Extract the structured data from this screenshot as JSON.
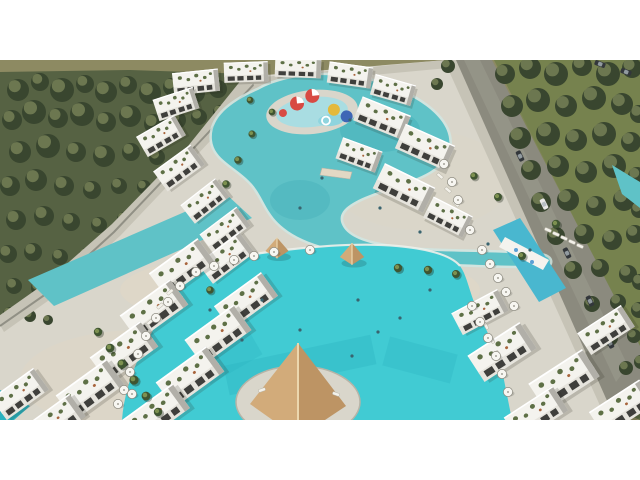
{
  "scene": {
    "name": "aerial-3d-render-resort-compound-with-lagoon-pools",
    "palette": {
      "sky": "#8d8a62",
      "forest_base": "#566243",
      "tree_dark": "#39462f",
      "tree_light": "#97a06c",
      "lawn": "#76824e",
      "lawn_dark": "#5a6942",
      "road": "#8b8a7e",
      "road_light": "#a09f92",
      "wall_light": "#c6c3b6",
      "wall_shadow": "#7b7a70",
      "deck": "#d9d6cb",
      "deck_warm": "#e2d8c4",
      "deck_shadow": "#b7b4a7",
      "lagoon": "#5fc2c7",
      "lagoon_deep": "#3da9b4",
      "splash": "#a9dde2",
      "pool": "#41cbd3",
      "pool_deep": "#2ab2c0",
      "building": "#f4f3ee",
      "building_face": "#e6e4dd",
      "building_shadow": "#b1afa8",
      "window": "#3f3f3c",
      "roof_green": "#5e7046",
      "terra": "#a8643c",
      "palm_dark": "#3f5531",
      "palm_light": "#7d9150",
      "umbrella": "#f7f6f1",
      "umbrella_rim": "#8b897e",
      "gazebo_top": "#ecd7ae",
      "gazebo_left": "#d2ab7a",
      "gazebo_right": "#bd9464",
      "slide_red": "#d84a43",
      "slide_yellow": "#e3b93c",
      "slide_blue": "#3e66b5",
      "car_dark": "#33373b",
      "car_white": "#e9e9e7",
      "swimmer": "#39646f",
      "letterbox": "#ffffff"
    },
    "trees_left": [
      [
        18,
        30,
        11
      ],
      [
        40,
        22,
        9
      ],
      [
        62,
        30,
        12
      ],
      [
        85,
        24,
        9
      ],
      [
        106,
        32,
        11
      ],
      [
        128,
        25,
        9
      ],
      [
        150,
        33,
        11
      ],
      [
        172,
        27,
        9
      ],
      [
        195,
        33,
        10
      ],
      [
        218,
        29,
        9
      ],
      [
        240,
        35,
        8
      ],
      [
        12,
        60,
        10
      ],
      [
        34,
        52,
        12
      ],
      [
        58,
        58,
        10
      ],
      [
        82,
        54,
        12
      ],
      [
        106,
        62,
        10
      ],
      [
        130,
        56,
        11
      ],
      [
        154,
        64,
        10
      ],
      [
        177,
        60,
        9
      ],
      [
        199,
        57,
        8
      ],
      [
        220,
        52,
        7
      ],
      [
        20,
        92,
        11
      ],
      [
        48,
        86,
        12
      ],
      [
        76,
        92,
        10
      ],
      [
        104,
        96,
        11
      ],
      [
        131,
        92,
        9
      ],
      [
        157,
        97,
        8
      ],
      [
        10,
        126,
        10
      ],
      [
        36,
        120,
        11
      ],
      [
        64,
        126,
        10
      ],
      [
        92,
        130,
        9
      ],
      [
        119,
        126,
        8
      ],
      [
        144,
        127,
        7
      ],
      [
        16,
        160,
        10
      ],
      [
        44,
        156,
        10
      ],
      [
        71,
        162,
        9
      ],
      [
        99,
        165,
        8
      ],
      [
        124,
        159,
        7
      ],
      [
        8,
        194,
        9
      ],
      [
        33,
        192,
        9
      ],
      [
        60,
        197,
        8
      ],
      [
        86,
        195,
        7
      ],
      [
        14,
        226,
        8
      ],
      [
        39,
        228,
        8
      ],
      [
        63,
        229,
        7
      ],
      [
        10,
        254,
        7
      ],
      [
        30,
        256,
        6
      ],
      [
        48,
        260,
        5
      ]
    ],
    "trees_right": [
      [
        505,
        14,
        10
      ],
      [
        530,
        8,
        11
      ],
      [
        556,
        14,
        12
      ],
      [
        582,
        6,
        10
      ],
      [
        608,
        14,
        12
      ],
      [
        632,
        8,
        10
      ],
      [
        512,
        46,
        11
      ],
      [
        538,
        40,
        12
      ],
      [
        566,
        46,
        11
      ],
      [
        594,
        38,
        12
      ],
      [
        622,
        44,
        11
      ],
      [
        639,
        54,
        9
      ],
      [
        520,
        78,
        11
      ],
      [
        548,
        74,
        12
      ],
      [
        576,
        80,
        11
      ],
      [
        604,
        74,
        12
      ],
      [
        631,
        82,
        10
      ],
      [
        531,
        110,
        10
      ],
      [
        558,
        106,
        11
      ],
      [
        586,
        112,
        11
      ],
      [
        614,
        106,
        12
      ],
      [
        637,
        116,
        9
      ],
      [
        541,
        142,
        10
      ],
      [
        568,
        140,
        11
      ],
      [
        596,
        146,
        10
      ],
      [
        624,
        140,
        11
      ],
      [
        639,
        150,
        8
      ],
      [
        556,
        176,
        9
      ],
      [
        584,
        174,
        10
      ],
      [
        612,
        180,
        10
      ],
      [
        635,
        174,
        9
      ],
      [
        573,
        210,
        9
      ],
      [
        600,
        208,
        9
      ],
      [
        628,
        214,
        9
      ],
      [
        640,
        222,
        8
      ],
      [
        592,
        244,
        8
      ],
      [
        618,
        242,
        8
      ],
      [
        639,
        250,
        8
      ],
      [
        610,
        278,
        8
      ],
      [
        634,
        276,
        7
      ],
      [
        626,
        308,
        7
      ],
      [
        641,
        302,
        7
      ],
      [
        624,
        340,
        8
      ],
      [
        640,
        336,
        8
      ],
      [
        448,
        6,
        7
      ],
      [
        437,
        24,
        6
      ]
    ],
    "buildings": [
      [
        196,
        22,
        -6,
        0.46,
        0.4
      ],
      [
        246,
        12,
        -2,
        0.44,
        0.36
      ],
      [
        298,
        8,
        2,
        0.46,
        0.34
      ],
      [
        350,
        15,
        8,
        0.44,
        0.38
      ],
      [
        393,
        30,
        16,
        0.42,
        0.38
      ],
      [
        176,
        44,
        -18,
        0.42,
        0.4
      ],
      [
        161,
        76,
        -30,
        0.44,
        0.42
      ],
      [
        179,
        108,
        -36,
        0.46,
        0.44
      ],
      [
        205,
        141,
        -38,
        0.44,
        0.42
      ],
      [
        225,
        170,
        -37,
        0.46,
        0.42
      ],
      [
        382,
        58,
        22,
        0.52,
        0.46
      ],
      [
        425,
        87,
        24,
        0.54,
        0.48
      ],
      [
        359,
        95,
        20,
        0.42,
        0.4
      ],
      [
        404,
        128,
        26,
        0.56,
        0.5
      ],
      [
        448,
        157,
        27,
        0.44,
        0.42
      ],
      [
        226,
        198,
        -37,
        0.52,
        0.46
      ],
      [
        182,
        208,
        -36,
        0.6,
        0.54
      ],
      [
        246,
        241,
        -36,
        0.58,
        0.52
      ],
      [
        154,
        250,
        -36,
        0.62,
        0.56
      ],
      [
        218,
        275,
        -36,
        0.6,
        0.56
      ],
      [
        124,
        292,
        -36,
        0.62,
        0.56
      ],
      [
        190,
        317,
        -36,
        0.62,
        0.56
      ],
      [
        90,
        330,
        -36,
        0.62,
        0.56
      ],
      [
        156,
        354,
        -36,
        0.62,
        0.54
      ],
      [
        54,
        362,
        -36,
        0.58,
        0.5
      ],
      [
        20,
        334,
        -36,
        0.52,
        0.48
      ],
      [
        480,
        252,
        -28,
        0.52,
        0.44
      ],
      [
        502,
        292,
        -33,
        0.62,
        0.56
      ],
      [
        564,
        320,
        -33,
        0.64,
        0.58
      ],
      [
        622,
        348,
        -33,
        0.6,
        0.52
      ],
      [
        536,
        354,
        -33,
        0.58,
        0.52
      ],
      [
        606,
        270,
        -33,
        0.52,
        0.46
      ]
    ],
    "palms": [
      [
        98,
        272,
        1
      ],
      [
        110,
        288,
        1.05
      ],
      [
        122,
        304,
        1.1
      ],
      [
        134,
        320,
        1.1
      ],
      [
        146,
        336,
        1.05
      ],
      [
        158,
        352,
        1
      ],
      [
        398,
        208,
        1
      ],
      [
        428,
        210,
        1
      ],
      [
        456,
        214,
        0.95
      ],
      [
        238,
        100,
        0.9
      ],
      [
        226,
        124,
        0.9
      ],
      [
        252,
        74,
        0.85
      ],
      [
        250,
        40,
        0.8
      ],
      [
        272,
        52,
        0.8
      ],
      [
        474,
        116,
        0.9
      ],
      [
        498,
        137,
        0.95
      ],
      [
        556,
        164,
        1.0
      ],
      [
        522,
        196,
        0.95
      ],
      [
        210,
        230,
        0.9
      ]
    ],
    "umbrellas": [
      [
        196,
        212
      ],
      [
        214,
        206
      ],
      [
        234,
        200
      ],
      [
        254,
        196
      ],
      [
        274,
        192
      ],
      [
        180,
        226
      ],
      [
        168,
        242
      ],
      [
        156,
        258
      ],
      [
        146,
        276
      ],
      [
        138,
        294
      ],
      [
        130,
        312
      ],
      [
        124,
        330
      ],
      [
        472,
        246
      ],
      [
        480,
        262
      ],
      [
        488,
        278
      ],
      [
        496,
        296
      ],
      [
        502,
        314
      ],
      [
        508,
        332
      ],
      [
        482,
        190
      ],
      [
        490,
        204
      ],
      [
        498,
        218
      ],
      [
        506,
        232
      ],
      [
        514,
        246
      ],
      [
        444,
        104
      ],
      [
        452,
        122
      ],
      [
        458,
        140
      ],
      [
        470,
        170
      ],
      [
        118,
        344
      ],
      [
        132,
        334
      ],
      [
        310,
        190
      ]
    ],
    "loungers": [
      [
        548,
        170,
        24
      ],
      [
        556,
        174,
        24
      ],
      [
        564,
        178,
        24
      ],
      [
        572,
        182,
        24
      ],
      [
        580,
        186,
        24
      ],
      [
        170,
        232,
        -40
      ],
      [
        160,
        246,
        -40
      ],
      [
        150,
        262,
        -40
      ],
      [
        486,
        266,
        60
      ],
      [
        492,
        280,
        60
      ],
      [
        498,
        294,
        60
      ],
      [
        440,
        116,
        40
      ],
      [
        448,
        130,
        40
      ],
      [
        456,
        144,
        40
      ],
      [
        262,
        330,
        -20
      ],
      [
        336,
        334,
        20
      ]
    ],
    "cars": [
      [
        520,
        96,
        64,
        "dark"
      ],
      [
        544,
        144,
        64,
        "white"
      ],
      [
        567,
        193,
        64,
        "dark"
      ],
      [
        590,
        241,
        64,
        "dark"
      ],
      [
        610,
        283,
        64,
        "dark"
      ],
      [
        600,
        4,
        20,
        "dark"
      ],
      [
        626,
        12,
        20,
        "dark"
      ]
    ],
    "gazebos": [
      [
        277,
        190,
        20
      ],
      [
        352,
        196,
        21
      ]
    ],
    "swimmers": [
      [
        350,
        60
      ],
      [
        322,
        118
      ],
      [
        380,
        148
      ],
      [
        300,
        148
      ],
      [
        420,
        172
      ],
      [
        488,
        184
      ],
      [
        262,
        240
      ],
      [
        300,
        270
      ],
      [
        358,
        240
      ],
      [
        400,
        258
      ],
      [
        430,
        230
      ],
      [
        242,
        280
      ],
      [
        352,
        296
      ],
      [
        378,
        272
      ],
      [
        210,
        250
      ],
      [
        530,
        190
      ]
    ]
  }
}
